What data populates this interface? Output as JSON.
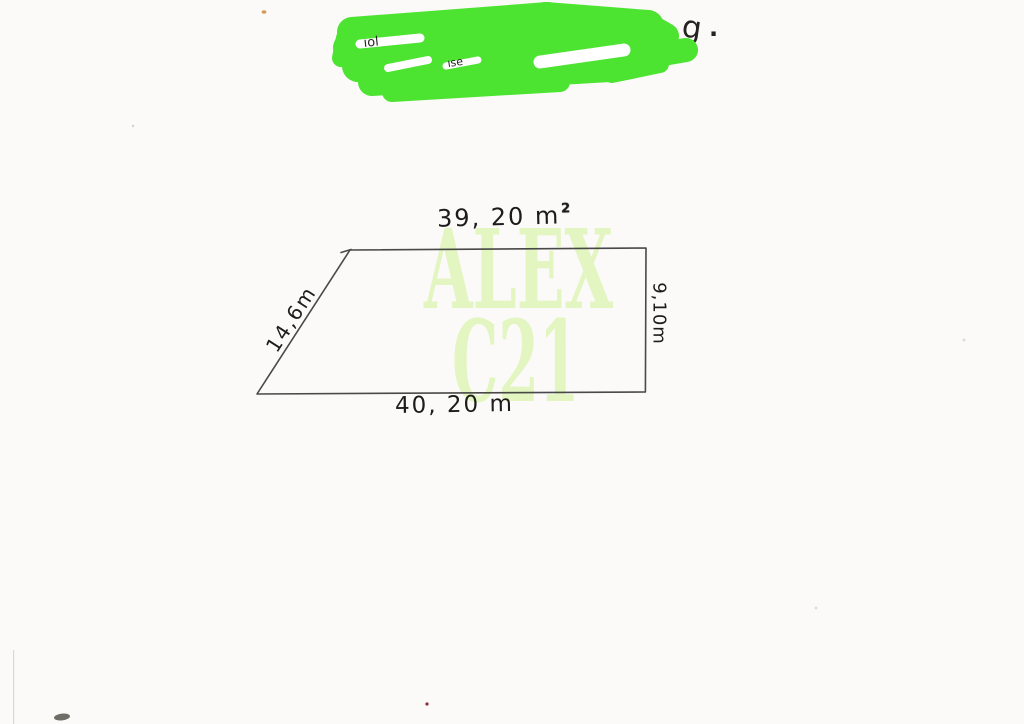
{
  "paper": {
    "color": "#fbfaf8",
    "ink_color": "#3a3a3a"
  },
  "redaction": {
    "marker_color": "#4ce331",
    "peek_fragments": [
      "l",
      "ı",
      "t",
      "ı",
      "t",
      "o",
      "g",
      "."
    ],
    "gap_fragments": [
      "ıol",
      "ıse"
    ]
  },
  "watermark": {
    "line1": "ALEX",
    "line2": "C21",
    "color": "#e3f5c1"
  },
  "figure": {
    "shape": "trapezoid",
    "labels": {
      "top": "39, 20 m",
      "top_sup": "2",
      "right": "9,10m",
      "bottom": "40, 20 m",
      "left": "14,6m"
    }
  }
}
